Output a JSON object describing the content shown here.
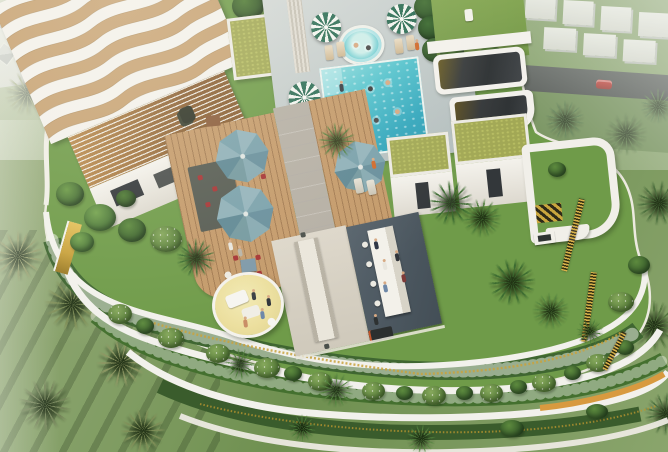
{
  "meta": {
    "scene": "aerial 3d rendering of curved residential tower rooftop amenity deck with pool gardens and surrounding palm resort grounds"
  },
  "palette": {
    "white-structure": "#f3f1ec",
    "wave-tan": "#c7a273",
    "pergola-amber": "#a87a45",
    "lawn-roof": "#6f9b49",
    "lawn-ground": "#7e9a62",
    "sedum-roof": "#a2a855",
    "pool-water": "#45b4c6",
    "pool-light": "#8fdbdc",
    "deck-wood": "#c49a6a",
    "stone-path": "#b5afa4",
    "umbrella-green": "#2f6f57",
    "umbrella-teal": "#7fa3ad",
    "gold-accent": "#c9a23d",
    "bar-floor": "#4e5a63",
    "road-asphalt": "#3d423f",
    "car-red": "#c13028",
    "lounge-cream": "#ecdf9e",
    "chair-red": "#a63434",
    "glass-dark": "#33373a",
    "flower-white": "#f6f8f2"
  },
  "objects": {
    "pool": {
      "label": "rooftop swimming pool",
      "swimmers": 7
    },
    "jacuzzi": {
      "label": "round spa pool at pool head"
    },
    "umbrellas": {
      "green_white_striped": 3,
      "teal_octagonal": 3
    },
    "wave_roof": {
      "label": "white roof slab with wavy timber inlay",
      "waves": 6
    },
    "pergola": {
      "label": "slatted pergola with hanging chairs"
    },
    "green_roof_cubes": {
      "count": 2,
      "label": "white pavilions with sedum roofs"
    },
    "skylight_structures": {
      "count": 2,
      "label": "white volumes with dark glazed roofs"
    },
    "bar": {
      "label": "outdoor bar counter",
      "stools": 4
    },
    "bbq": {
      "label": "grill station"
    },
    "sunken_lounge": {
      "label": "circular cream lounge pit with daybeds"
    },
    "dining": {
      "label": "long communal table on concrete terrace"
    },
    "cascading_balconies": {
      "label": "curved white balcony bands with planted edges and gold slats"
    },
    "surroundings": {
      "tent_villas": "upper-left resort",
      "white_villas": "upper-right",
      "road": "upper-right with one red car",
      "palm_grounds": "left and bottom"
    }
  }
}
